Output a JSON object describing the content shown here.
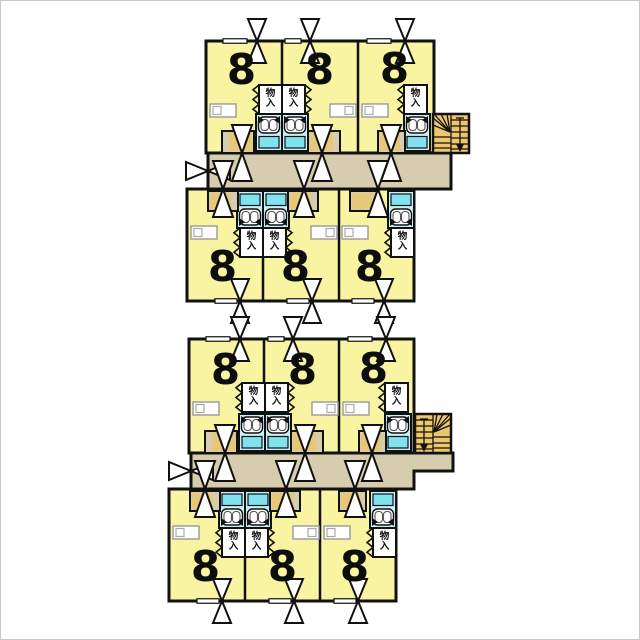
{
  "colors": {
    "room": "#F8F4A2",
    "corridor": "#D6CDAF",
    "entry": "#E6C878",
    "stairs": "#EDC76C",
    "bath_floor": "#C9F0F6",
    "bath_tub": "#7FE3EF",
    "wall": "#111111",
    "background": "#FFFFFF"
  },
  "plans": [
    {
      "id": "upper-floor-plan",
      "rows": [
        {
          "units": [
            {
              "size": "8",
              "closet": "物入"
            },
            {
              "size": "8",
              "closet": "物入"
            },
            {
              "size": "8",
              "closet": "物入"
            }
          ]
        },
        {
          "units": [
            {
              "size": "8",
              "closet": "物入"
            },
            {
              "size": "8",
              "closet": "物入"
            },
            {
              "size": "8",
              "closet": "物入"
            }
          ]
        }
      ]
    },
    {
      "id": "lower-floor-plan",
      "rows": [
        {
          "units": [
            {
              "size": "8",
              "closet": "物入"
            },
            {
              "size": "8",
              "closet": "物入"
            },
            {
              "size": "8",
              "closet": "物入"
            }
          ]
        },
        {
          "units": [
            {
              "size": "8",
              "closet": "物入"
            },
            {
              "size": "8",
              "closet": "物入"
            },
            {
              "size": "8",
              "closet": "物入"
            }
          ]
        }
      ]
    }
  ]
}
